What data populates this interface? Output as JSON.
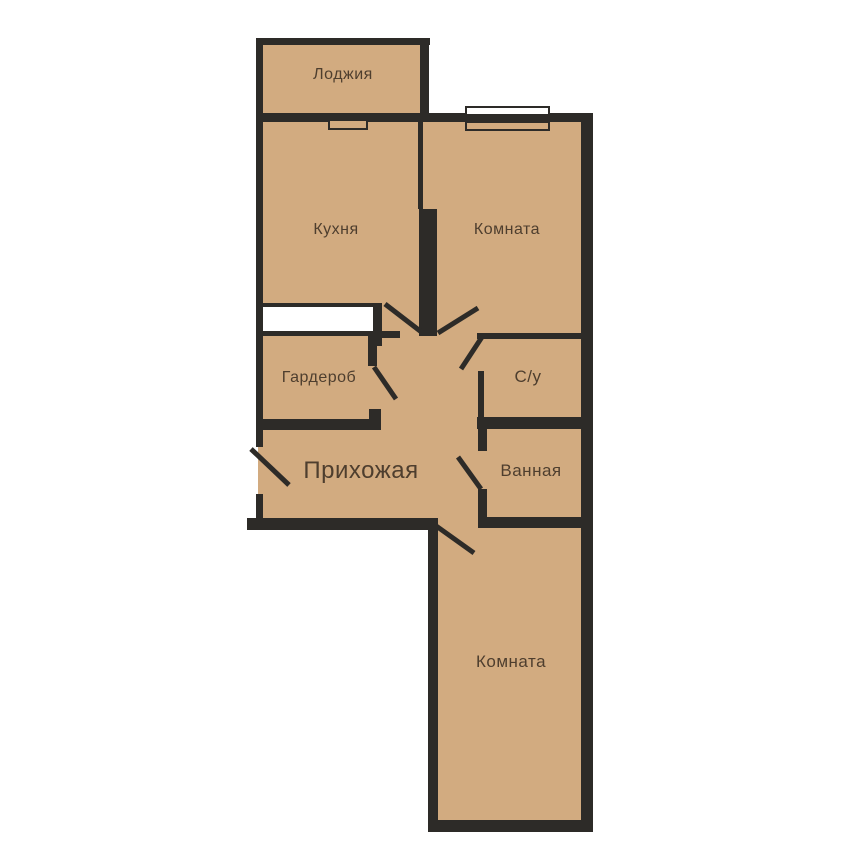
{
  "floorplan": {
    "type": "apartment-floor-plan",
    "rooms": {
      "loggia": {
        "label": "Лоджия"
      },
      "kitchen": {
        "label": "Кухня"
      },
      "room_top": {
        "label": "Комната"
      },
      "wardrobe": {
        "label": "Гардероб"
      },
      "wc": {
        "label": "С/у"
      },
      "hallway": {
        "label": "Прихожая"
      },
      "bathroom": {
        "label": "Ванная"
      },
      "room_bottom": {
        "label": "Комната"
      }
    },
    "windows": [
      "room-top-window",
      "loggia-kitchen-window"
    ],
    "doors": [
      "entrance-door-swing",
      "kitchen-door-swing",
      "room-top-door-swing",
      "wc-door-swing",
      "bathroom-door-swing",
      "room-bottom-door-swing",
      "wardrobe-door-swing"
    ],
    "colors": {
      "floor": "#d2ab80",
      "wall": "#2d2b28",
      "outside": "#ffffff",
      "opening": "#ffffff",
      "label": "#4e3e2e"
    }
  }
}
